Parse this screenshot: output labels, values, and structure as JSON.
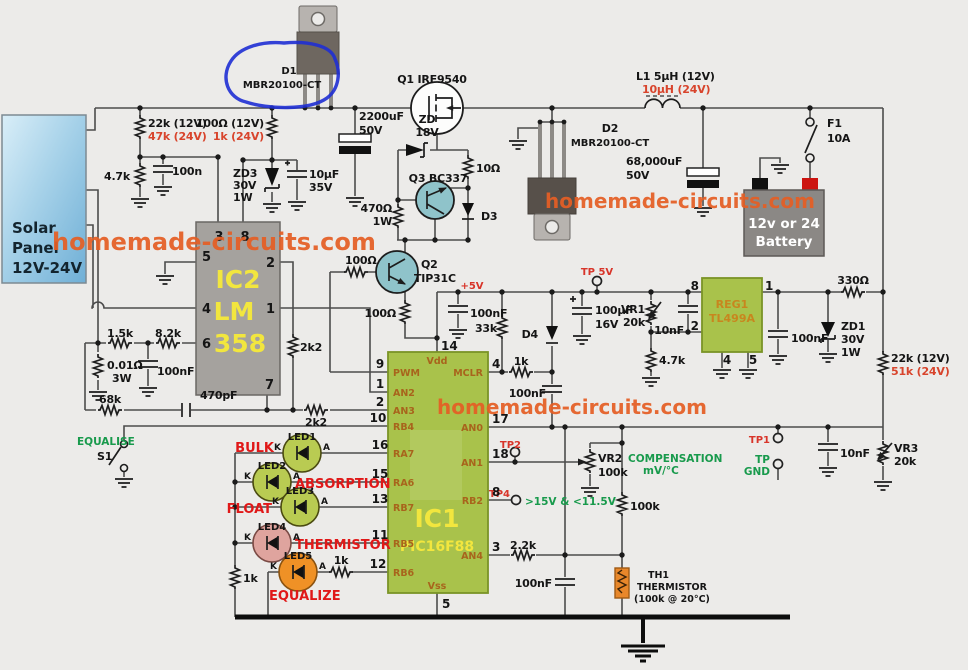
{
  "watermark": "homemade-circuits.com",
  "panel": {
    "l1": "Solar",
    "l2": "Panel",
    "l3": "12V-24V"
  },
  "top": {
    "d1_ref": "D1",
    "d1_val": "MBR20100-CT",
    "q1": "Q1 IRF9540",
    "c2200": "2200uF",
    "c2200_v": "50V",
    "zd": "ZD",
    "zd_v": "18V",
    "r22k_a": "22k (12V)",
    "r22k_b": "47k (24V)",
    "r100_a": "100Ω (12V)",
    "r100_b": "1k (24V)",
    "r4k7": "4.7k",
    "c100n": "100n",
    "zd3_1": "ZD3",
    "zd3_2": "30V",
    "zd3_3": "1W",
    "c10u": "10μF",
    "c10u_v": "35V",
    "r470": "470Ω",
    "r470_w": "1W",
    "q3": "Q3 BC337",
    "r10": "10Ω",
    "d3": "D3",
    "d2_ref": "D2",
    "d2_val": "MBR20100-CT",
    "l1_a": "L1 5μH (12V)",
    "l1_b": "10μH (24V)",
    "c68000": "68,000uF",
    "c68000_v": "50V",
    "f1": "F1",
    "f1_v": "10A",
    "bat1": "12v or 24",
    "bat2": "Battery"
  },
  "mid": {
    "q2_ref": "Q2",
    "q2_val": "TIP31C",
    "r100_base": "100Ω",
    "r100_em": "100Ω",
    "r2k2_v": "2k2",
    "r2k2_h": "2k2",
    "ic2_ref": "IC2",
    "ic2_a": "LM",
    "ic2_b": "358",
    "ic2_p3": "3",
    "ic2_p8": "8",
    "ic2_p5": "5",
    "ic2_p4": "4",
    "ic2_p6": "6",
    "ic2_p2": "2",
    "ic2_p1": "1",
    "ic2_p7": "7",
    "r1k5": "1.5k",
    "r8k2": "8.2k",
    "r001": "0.01Ω",
    "r001_w": "3W",
    "c100n": "100nF",
    "r68k": "68k",
    "c470p": "470pF",
    "equalise": "EQUALISE",
    "s1": "S1"
  },
  "leds": {
    "k": "K",
    "a": "A",
    "r1k_bus": "1k",
    "r1k_eq": "1k",
    "items": [
      {
        "ref": "LED1",
        "cap": "BULK"
      },
      {
        "ref": "LED2",
        "cap": "ABSORPTION"
      },
      {
        "ref": "LED3",
        "cap": "FLOAT"
      },
      {
        "ref": "LED4",
        "cap": "THERMISTOR"
      },
      {
        "ref": "LED5",
        "cap": "EQUALIZE"
      }
    ]
  },
  "ic1": {
    "ref": "IC1",
    "val": "PIC16F88",
    "vdd": "Vdd",
    "vss": "Vss",
    "p14": "14",
    "p5": "5",
    "left": [
      {
        "n": "9",
        "l": "PWM"
      },
      {
        "n": "1",
        "l": "AN2"
      },
      {
        "n": "2",
        "l": "AN3"
      },
      {
        "n": "10",
        "l": "RB4"
      },
      {
        "n": "16",
        "l": "RA7"
      },
      {
        "n": "15",
        "l": "RA6"
      },
      {
        "n": "13",
        "l": "RB7"
      },
      {
        "n": "11",
        "l": "RB5"
      },
      {
        "n": "12",
        "l": "RB6"
      }
    ],
    "right": [
      {
        "n": "4",
        "l": "MCLR"
      },
      {
        "n": "17",
        "l": "AN0"
      },
      {
        "n": "18",
        "l": "AN1"
      },
      {
        "n": "8",
        "l": "RB2"
      },
      {
        "n": "3",
        "l": "AN4"
      }
    ]
  },
  "rails": {
    "plus5": "+5V",
    "tp5v": "TP 5V"
  },
  "mcu_area": {
    "c100n_5v": "100nF",
    "r33k": "33k",
    "d4": "D4",
    "r1k": "1k",
    "c100n_mclr": "100nF",
    "c100u": "100μF",
    "c100u_v": "16V"
  },
  "reg": {
    "ref": "REG1",
    "val": "TL499A",
    "p8": "8",
    "p2": "2",
    "p1": "1",
    "p4": "4",
    "p5": "5",
    "vr1_ref": "VR1",
    "vr1_val": "20k",
    "c10n": "10nF",
    "r4k7": "4.7k",
    "c100n": "100nF",
    "zd1_1": "ZD1",
    "zd1_2": "30V",
    "zd1_3": "1W",
    "r330": "330Ω",
    "r22k_a": "22k (12V)",
    "r22k_b": "51k (24V)"
  },
  "right": {
    "tp1": "TP1",
    "tp_gnd_a": "TP",
    "tp_gnd_b": "GND",
    "c10n": "10nF",
    "vr3_ref": "VR3",
    "vr3_val": "20k"
  },
  "sense": {
    "tp2": "TP2",
    "tp4": "TP4",
    "tp4_note": ">15V & <11.5V",
    "comp_a": "COMPENSATION",
    "comp_b": "mV/°C",
    "vr2_ref": "VR2",
    "vr2_val": "100k",
    "r100k": "100k",
    "r2k2": "2.2k",
    "c100n": "100nF",
    "th1_a": "TH1",
    "th1_b": "THERMISTOR",
    "th1_c": "(100k @ 20°C)"
  }
}
